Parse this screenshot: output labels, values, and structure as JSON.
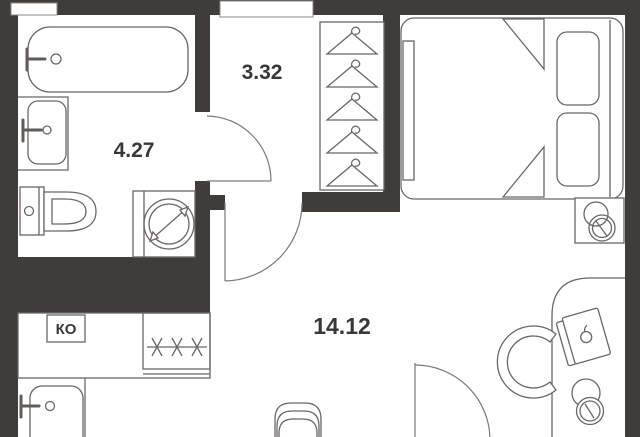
{
  "plan": {
    "type": "apartment-floor-plan",
    "colors": {
      "wall": "#403c3a",
      "floor": "#ffffff",
      "fixture_line": "#6a6764",
      "label_text": "#3a3836"
    },
    "rooms": [
      {
        "id": "bathroom",
        "area_label": "4.27"
      },
      {
        "id": "hallway",
        "area_label": "3.32"
      },
      {
        "id": "living-room",
        "area_label": "14.12"
      }
    ],
    "kitchen_unit_label": "КО",
    "fixtures": [
      "bathtub",
      "bathroom-sink",
      "toilet",
      "washing-machine",
      "wardrobe-hangers",
      "bed",
      "pillows",
      "headboard",
      "nightstand",
      "table-lamp",
      "desk",
      "laptop",
      "desk-chair",
      "kitchen-counter",
      "stove-burners",
      "kitchen-sink",
      "chair",
      "interior-door",
      "room-door",
      "balcony-door"
    ]
  }
}
